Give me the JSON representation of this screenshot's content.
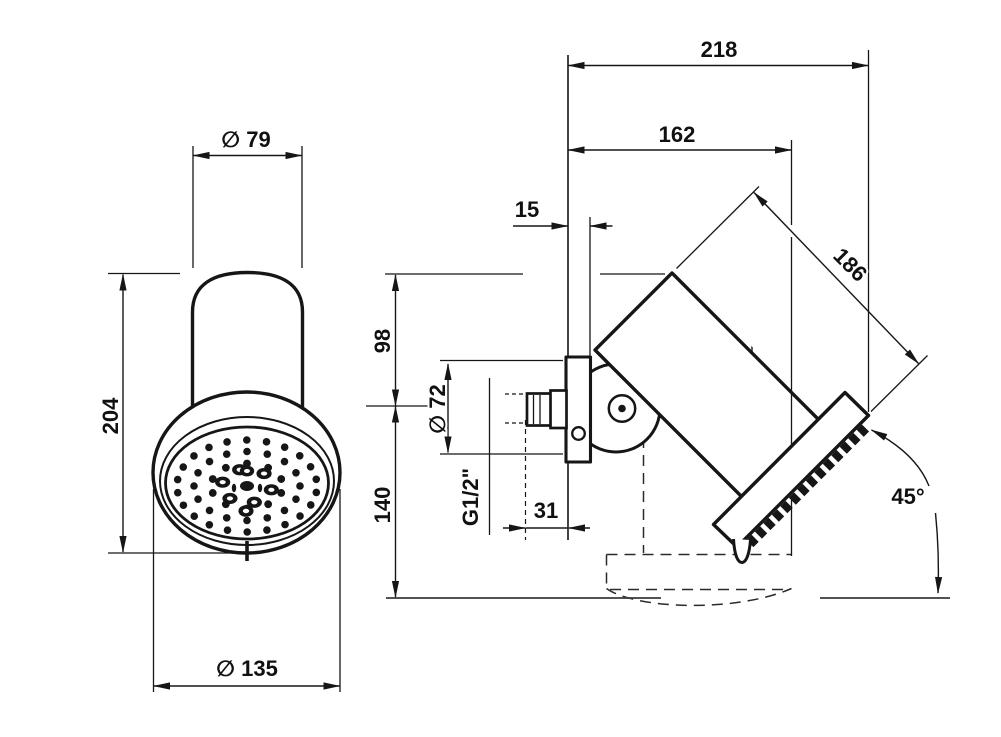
{
  "title": "Shower head dimensional drawing",
  "colors": {
    "line": "#161616",
    "background": "#ffffff"
  },
  "front_view": {
    "dim_diameter_top": "∅ 79",
    "dim_height": "204",
    "dim_diameter_head": "∅ 135",
    "nozzles": {
      "center": [
        247,
        486
      ],
      "rings": [
        {
          "n": 22,
          "rx": 70,
          "ry": 46,
          "r": 3.8,
          "phase": 8
        },
        {
          "n": 16,
          "rx": 53,
          "ry": 34.5,
          "r": 3.8,
          "phase": 0
        },
        {
          "n": 10,
          "rx": 36,
          "ry": 22.5,
          "r": 3.9,
          "phase": 18
        }
      ],
      "donut_ring": {
        "n": 6,
        "rx": 25,
        "ry": 17,
        "orx": 7.6,
        "ory": 5.6,
        "irx": 3.1,
        "iry": 2.1,
        "phase": 13
      },
      "center_items": [
        {
          "type": "donut",
          "dx": 0,
          "dy": -15,
          "orx": 7.2,
          "ory": 5.4,
          "irx": 3,
          "iry": 2
        },
        {
          "type": "solid",
          "dx": 0,
          "dy": 0,
          "orx": 7,
          "ory": 5
        },
        {
          "type": "donut",
          "dx": -1,
          "dy": 25,
          "orx": 7.6,
          "ory": 5.8,
          "irx": 3.2,
          "iry": 2.2
        },
        {
          "type": "solid",
          "dx": -13,
          "dy": 2,
          "orx": 2.2,
          "ory": 4.2
        },
        {
          "type": "solid",
          "dx": 13,
          "dy": 2,
          "orx": 2.2,
          "ory": 4.2
        }
      ]
    }
  },
  "side_view": {
    "dim_wall_to_front": "218",
    "dim_wall_to_head": "162",
    "dim_plate_depth": "15",
    "dim_head_length": "186",
    "dim_top_to_axis": "98",
    "dim_plate_diameter": "∅ 72",
    "thread_label": "G1/2\"",
    "dim_axis_to_bottom": "140",
    "dim_thread_to_wall": "31",
    "dim_angle": "45°"
  }
}
